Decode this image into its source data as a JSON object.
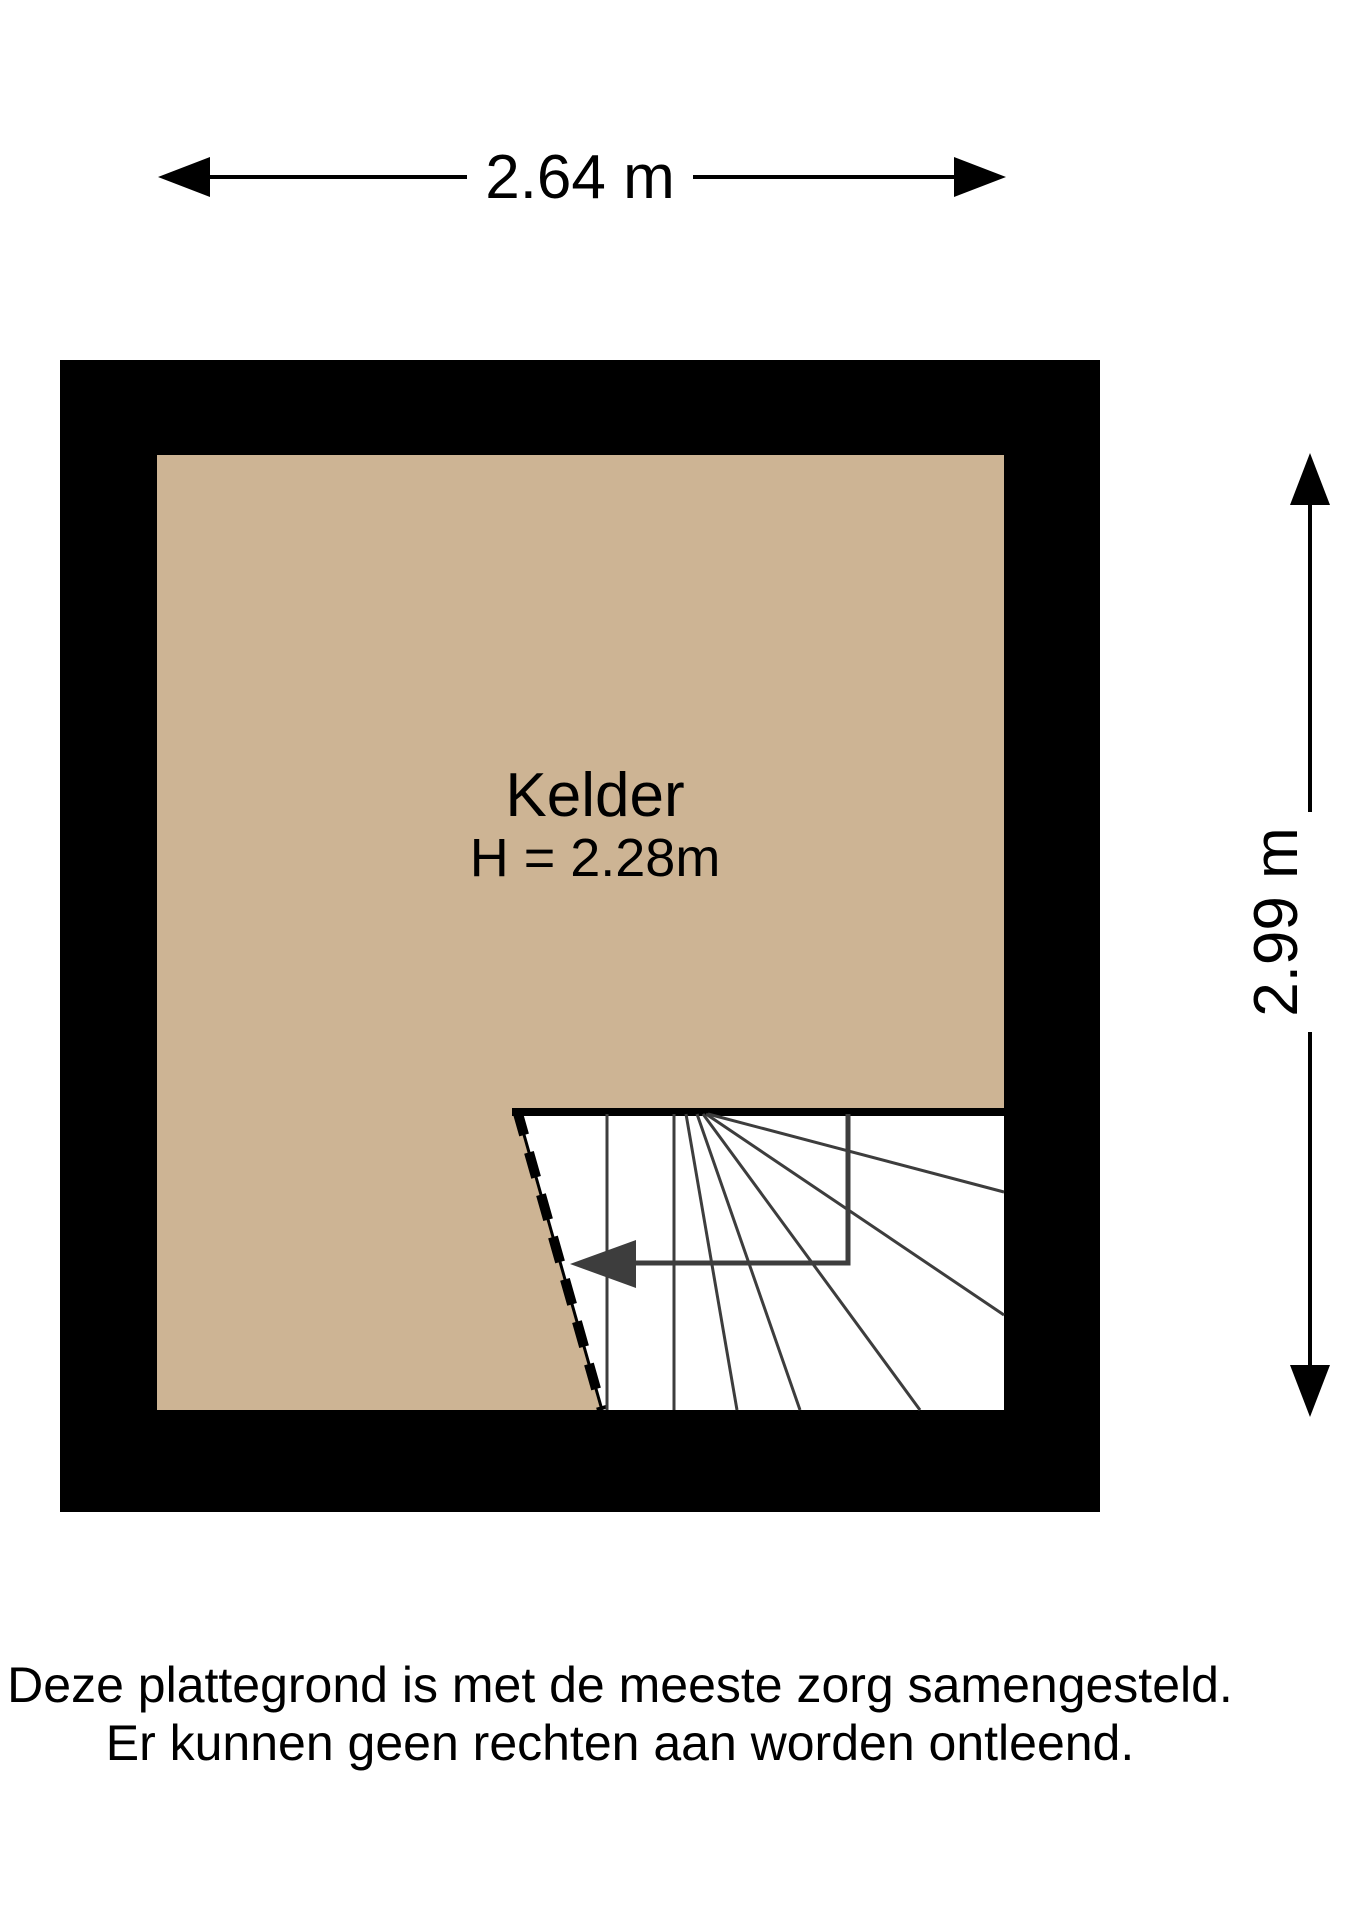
{
  "floorplan": {
    "room": {
      "name": "Kelder",
      "ceiling_height_label": "H = 2.28m"
    },
    "dimensions": {
      "width_label": "2.64 m",
      "height_label": "2.99 m"
    },
    "disclaimer": {
      "line1": "Deze plattegrond is met de meeste zorg samengesteld.",
      "line2": "Er kunnen geen rechten aan worden ontleend."
    },
    "colors": {
      "wall": "#000000",
      "floor": "#cdb494",
      "stair_lines": "#3d3d3d",
      "background": "#ffffff"
    }
  }
}
